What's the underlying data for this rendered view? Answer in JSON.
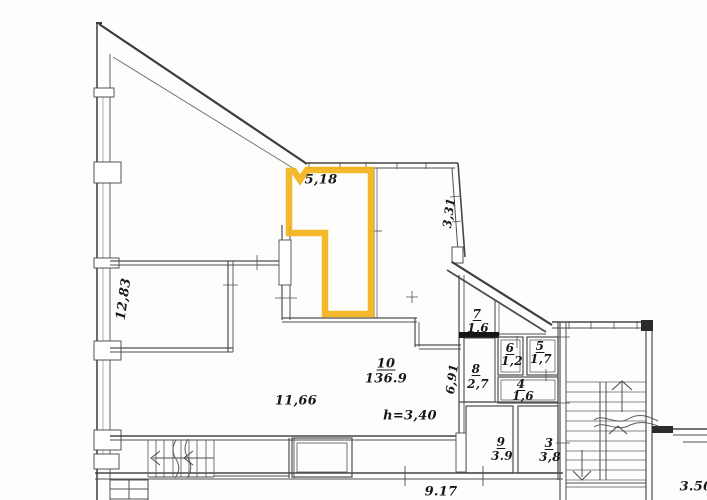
{
  "plan": {
    "highlight_color": "#F3B41B",
    "rooms": {
      "r10": {
        "number": "10",
        "area": "136.9"
      },
      "r7": {
        "number": "7",
        "area": "1,6"
      },
      "r6": {
        "number": "6",
        "area": "1,2"
      },
      "r5": {
        "number": "5",
        "area": "1,7"
      },
      "r8": {
        "number": "8",
        "area": "2,7"
      },
      "r4": {
        "number": "4",
        "area": "1,6"
      },
      "r9": {
        "number": "9",
        "area": "3.9"
      },
      "r3": {
        "number": "3",
        "area": "3,8"
      }
    },
    "dimensions": {
      "top_width": "5,18",
      "right_wall": "3,31",
      "left_wall": "12,83",
      "inner_wall": "6,91",
      "lower_left_width": "11,66",
      "ceiling_height": "h=3,40",
      "bottom_width": "9.17",
      "bottom_right": "3.50"
    }
  }
}
